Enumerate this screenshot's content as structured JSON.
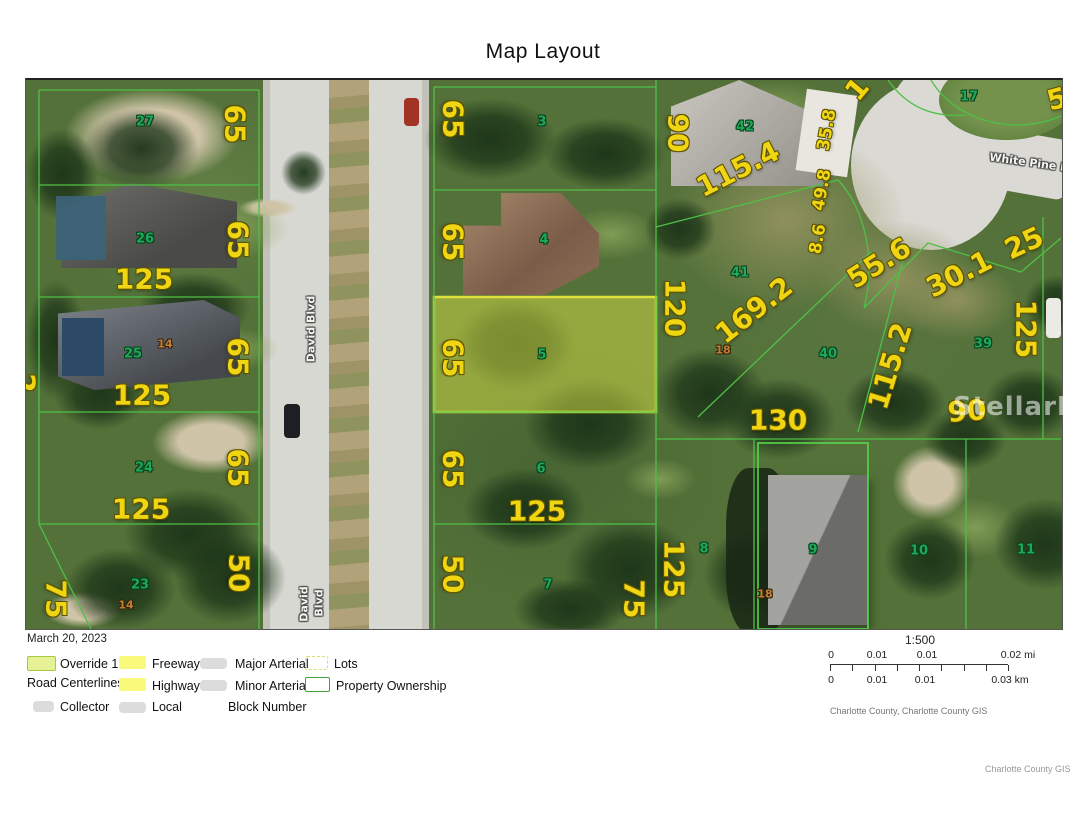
{
  "title": "Map Layout",
  "map": {
    "watermark": "StellarMLS",
    "labels": [
      {
        "t": "65",
        "x": 234,
        "y": 122,
        "r": 90,
        "k": "dim"
      },
      {
        "t": "65",
        "x": 237,
        "y": 238,
        "r": 90,
        "k": "dim"
      },
      {
        "t": "65",
        "x": 237,
        "y": 355,
        "r": 90,
        "k": "dim"
      },
      {
        "t": "65",
        "x": 237,
        "y": 466,
        "r": 90,
        "k": "dim"
      },
      {
        "t": "50",
        "x": 238,
        "y": 571,
        "r": 90,
        "k": "dim"
      },
      {
        "t": "125",
        "x": 143,
        "y": 277,
        "r": 0,
        "k": "dim"
      },
      {
        "t": "125",
        "x": 141,
        "y": 393,
        "r": 0,
        "k": "dim"
      },
      {
        "t": "125",
        "x": 140,
        "y": 507,
        "r": 0,
        "k": "dim"
      },
      {
        "t": "75",
        "x": 55,
        "y": 597,
        "r": 90,
        "k": "dim"
      },
      {
        "t": "2",
        "x": 24,
        "y": 381,
        "r": 90,
        "k": "dim"
      },
      {
        "t": "65",
        "x": 452,
        "y": 117,
        "r": 90,
        "k": "dim"
      },
      {
        "t": "65",
        "x": 452,
        "y": 240,
        "r": 90,
        "k": "dim"
      },
      {
        "t": "65",
        "x": 452,
        "y": 356,
        "r": 90,
        "k": "dim"
      },
      {
        "t": "65",
        "x": 452,
        "y": 467,
        "r": 90,
        "k": "dim"
      },
      {
        "t": "50",
        "x": 452,
        "y": 572,
        "r": 90,
        "k": "dim"
      },
      {
        "t": "125",
        "x": 536,
        "y": 509,
        "r": 0,
        "k": "dim"
      },
      {
        "t": "75",
        "x": 633,
        "y": 597,
        "r": 90,
        "k": "dim"
      },
      {
        "t": "125",
        "x": 673,
        "y": 567,
        "r": 90,
        "k": "dim"
      },
      {
        "t": "90",
        "x": 677,
        "y": 131,
        "r": 90,
        "k": "dim"
      },
      {
        "t": "115.4",
        "x": 737,
        "y": 167,
        "r": -27,
        "k": "dim"
      },
      {
        "t": "1",
        "x": 856,
        "y": 87,
        "r": -50,
        "k": "dim"
      },
      {
        "t": "35.8",
        "x": 826,
        "y": 128,
        "r": -80,
        "k": "dim-md"
      },
      {
        "t": "49.8",
        "x": 821,
        "y": 188,
        "r": -80,
        "k": "dim-md"
      },
      {
        "t": "8.6",
        "x": 817,
        "y": 237,
        "r": -80,
        "k": "dim-md"
      },
      {
        "t": "55.6",
        "x": 878,
        "y": 261,
        "r": -32,
        "k": "dim"
      },
      {
        "t": "30.1",
        "x": 958,
        "y": 272,
        "r": -27,
        "k": "dim"
      },
      {
        "t": "25",
        "x": 1023,
        "y": 241,
        "r": -25,
        "k": "dim"
      },
      {
        "t": "125",
        "x": 1025,
        "y": 327,
        "r": 90,
        "k": "dim"
      },
      {
        "t": "169.2",
        "x": 753,
        "y": 308,
        "r": -38,
        "k": "dim"
      },
      {
        "t": "115.2",
        "x": 889,
        "y": 364,
        "r": -73,
        "k": "dim"
      },
      {
        "t": "120",
        "x": 674,
        "y": 306,
        "r": 90,
        "k": "dim"
      },
      {
        "t": "130",
        "x": 777,
        "y": 418,
        "r": 0,
        "k": "dim"
      },
      {
        "t": "90",
        "x": 966,
        "y": 409,
        "r": -4,
        "k": "dim"
      },
      {
        "t": "5",
        "x": 1056,
        "y": 97,
        "r": -15,
        "k": "dim"
      },
      {
        "t": "27",
        "x": 144,
        "y": 120,
        "r": 0,
        "k": "lot"
      },
      {
        "t": "26",
        "x": 144,
        "y": 237,
        "r": 0,
        "k": "lot"
      },
      {
        "t": "25",
        "x": 132,
        "y": 352,
        "r": 0,
        "k": "lot"
      },
      {
        "t": "24",
        "x": 143,
        "y": 466,
        "r": 0,
        "k": "lot"
      },
      {
        "t": "23",
        "x": 139,
        "y": 583,
        "r": 0,
        "k": "lot"
      },
      {
        "t": "3",
        "x": 541,
        "y": 120,
        "r": 0,
        "k": "lot"
      },
      {
        "t": "4",
        "x": 543,
        "y": 238,
        "r": 0,
        "k": "lot"
      },
      {
        "t": "5",
        "x": 541,
        "y": 353,
        "r": 0,
        "k": "lot"
      },
      {
        "t": "6",
        "x": 540,
        "y": 467,
        "r": 0,
        "k": "lot"
      },
      {
        "t": "7",
        "x": 547,
        "y": 583,
        "r": 0,
        "k": "lot"
      },
      {
        "t": "42",
        "x": 744,
        "y": 125,
        "r": 0,
        "k": "lot"
      },
      {
        "t": "41",
        "x": 739,
        "y": 271,
        "r": 0,
        "k": "lot"
      },
      {
        "t": "40",
        "x": 827,
        "y": 352,
        "r": 0,
        "k": "lot"
      },
      {
        "t": "39",
        "x": 982,
        "y": 342,
        "r": 0,
        "k": "lot"
      },
      {
        "t": "17",
        "x": 968,
        "y": 95,
        "r": 0,
        "k": "lot"
      },
      {
        "t": "8",
        "x": 703,
        "y": 547,
        "r": 0,
        "k": "lot"
      },
      {
        "t": "9",
        "x": 812,
        "y": 548,
        "r": 0,
        "k": "lot"
      },
      {
        "t": "10",
        "x": 918,
        "y": 549,
        "r": 0,
        "k": "lot"
      },
      {
        "t": "11",
        "x": 1025,
        "y": 548,
        "r": 0,
        "k": "lot"
      },
      {
        "t": "14",
        "x": 164,
        "y": 342,
        "r": 0,
        "k": "block"
      },
      {
        "t": "14",
        "x": 125,
        "y": 603,
        "r": 0,
        "k": "block"
      },
      {
        "t": "18",
        "x": 722,
        "y": 348,
        "r": 0,
        "k": "block"
      },
      {
        "t": "18",
        "x": 764,
        "y": 592,
        "r": 0,
        "k": "block"
      },
      {
        "t": "David Blvd",
        "x": 310,
        "y": 327,
        "r": -90,
        "k": "street"
      },
      {
        "t": "David",
        "x": 303,
        "y": 602,
        "r": -90,
        "k": "street"
      },
      {
        "t": "Blvd",
        "x": 318,
        "y": 601,
        "r": -90,
        "k": "street"
      },
      {
        "t": "White Pine Dr",
        "x": 1031,
        "y": 161,
        "r": 8,
        "k": "street"
      },
      {
        "t": "StellarMLS",
        "x": 1037,
        "y": 407,
        "r": 0,
        "k": "wm"
      }
    ]
  },
  "legend": {
    "date": "March 20, 2023",
    "override1": "Override 1",
    "road_centerlines": "Road Centerlines",
    "collector": "Collector",
    "freeway": "Freeway",
    "highway": "Highway",
    "local": "Local",
    "major_arterial": "Major Arterial",
    "minor_arterial": "Minor Arterial",
    "block_number": "Block Number",
    "lots": "Lots",
    "property_ownership": "Property Ownership"
  },
  "scalebar": {
    "ratio": "1:500",
    "mi": [
      "0",
      "0.01",
      "0.01",
      "0.02 mi"
    ],
    "km": [
      "0",
      "0.01",
      "0.01",
      "0.03 km"
    ]
  },
  "credits": {
    "source": "Charlotte County, Charlotte County GIS",
    "attribution": "Charlotte County GIS"
  },
  "colors": {
    "dimension_text": "#f0d513",
    "lot_number_text": "#1fa85c",
    "block_number_text": "#c08034",
    "parcel_line": "#4fc046",
    "override_fill": "#e1e95a"
  }
}
